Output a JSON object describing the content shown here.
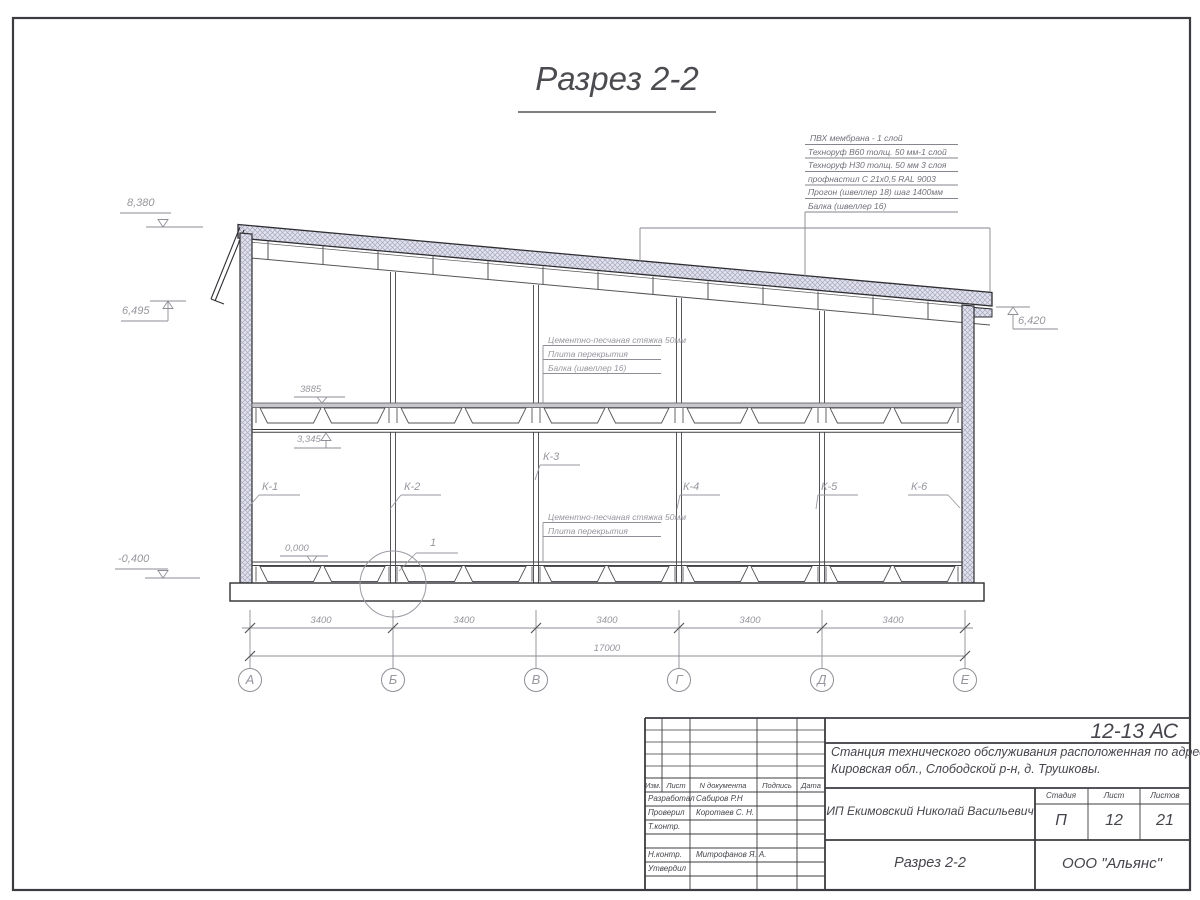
{
  "title": {
    "text": "Разрез 2-2"
  },
  "roof_callout": {
    "lines": [
      "ПВХ мембрана - 1 слой",
      "Техноруф В60 толщ. 50 мм-1 слой",
      "Техноруф Н30 толщ. 50 мм 3 слоя",
      "профнастил С 21х0,5 RAL 9003",
      "Прогон (швеллер 18) шаг 1400мм",
      "Балка (швеллер 16)"
    ]
  },
  "elevations": {
    "roof_top": "8,380",
    "parapet_left": "6,495",
    "eave_right": "6,420",
    "floor2": "3,345",
    "floor1": "0,000",
    "ground": "-0,400"
  },
  "notes": {
    "upper": [
      "Цементно-песчаная стяжка 50мм",
      "Плита перекрытия",
      "Балка (швеллер 16)"
    ],
    "lower": [
      "Цементно-песчаная стяжка 50мм",
      "Плита перекрытия"
    ]
  },
  "columns": [
    "К-1",
    "К-2",
    "К-3",
    "К-4",
    "К-5",
    "К-6"
  ],
  "detail": {
    "label": "1"
  },
  "dims": {
    "slab_span": "3885",
    "bays": [
      "3400",
      "3400",
      "3400",
      "3400",
      "3400"
    ],
    "total": "17000"
  },
  "axes": [
    "А",
    "Б",
    "В",
    "Г",
    "Д",
    "Е"
  ],
  "tb": {
    "doc_code": "12-13 АС",
    "project_line1": "Станция технического обслуживания расположенная по адресу",
    "project_line2": "Кировская обл., Слободской р-н, д. Трушковы.",
    "client": "ИП Екимовский Николай Васильевич",
    "sheet_title": "Разрез 2-2",
    "org": "ООО \"Альянс\"",
    "stage_label": "Стадия",
    "sheet_label": "Лист",
    "sheets_label": "Листов",
    "stage": "П",
    "sheet": "12",
    "sheets": "21",
    "header": [
      "Изм.",
      "Лист",
      "N документа",
      "Подпись",
      "Дата"
    ],
    "staff": [
      {
        "role": "Разработал",
        "name": "Сабиров Р.Н"
      },
      {
        "role": "Проверил",
        "name": "Коротаев С. Н."
      },
      {
        "role": "Т.контр.",
        "name": ""
      },
      {
        "role": "Н.контр.",
        "name": "Митрофанов Я. А."
      },
      {
        "role": "Утвердил",
        "name": ""
      }
    ]
  }
}
